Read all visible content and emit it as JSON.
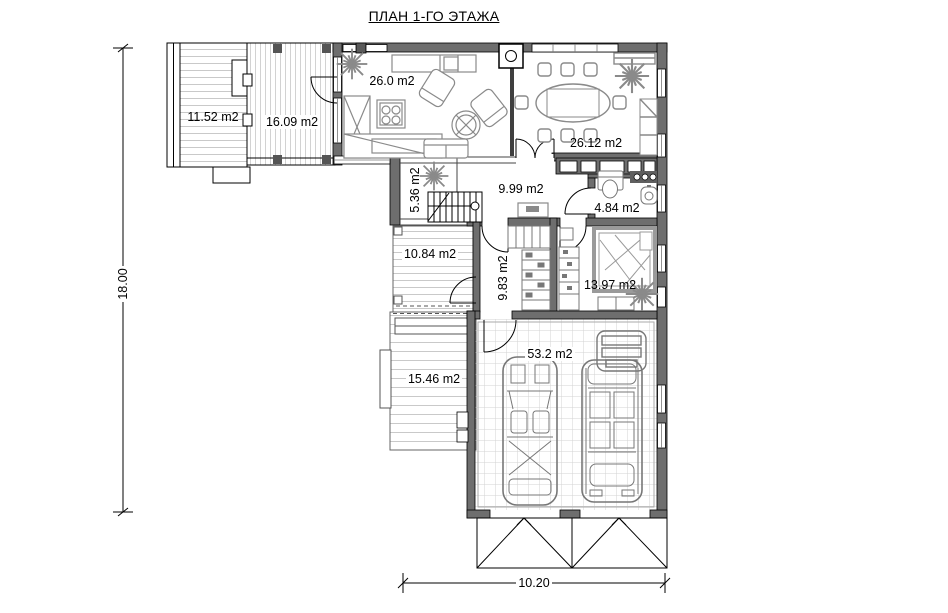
{
  "title": "ПЛАН 1-ГО ЭТАЖА",
  "dimensions": {
    "height_total": "18.00",
    "width_bottom": "10.20"
  },
  "rooms": {
    "deck_upper": {
      "label": "11.52 m2"
    },
    "terrace": {
      "label": "16.09 m2"
    },
    "living": {
      "label": "26.0 m2"
    },
    "dining": {
      "label": "26.12 m2"
    },
    "stair_hall": {
      "label": "5.36 m2"
    },
    "hall": {
      "label": "9.99 m2"
    },
    "bathroom": {
      "label": "4.84 m2"
    },
    "deck_middle": {
      "label": "10.84 m2"
    },
    "wardrobe": {
      "label": "9.83 m2"
    },
    "bedroom": {
      "label": "13.97 m2"
    },
    "deck_lower": {
      "label": "15.46 m2"
    },
    "garage": {
      "label": "53.2 m2"
    }
  },
  "colors": {
    "background": "#ffffff",
    "wall_fill": "#6e6e6e",
    "dark_post": "#555555",
    "furniture_stroke": "#8a8a8a",
    "hatch_line": "#c9c9c9",
    "grid_line": "#d3d3d3",
    "line": "#000000"
  }
}
